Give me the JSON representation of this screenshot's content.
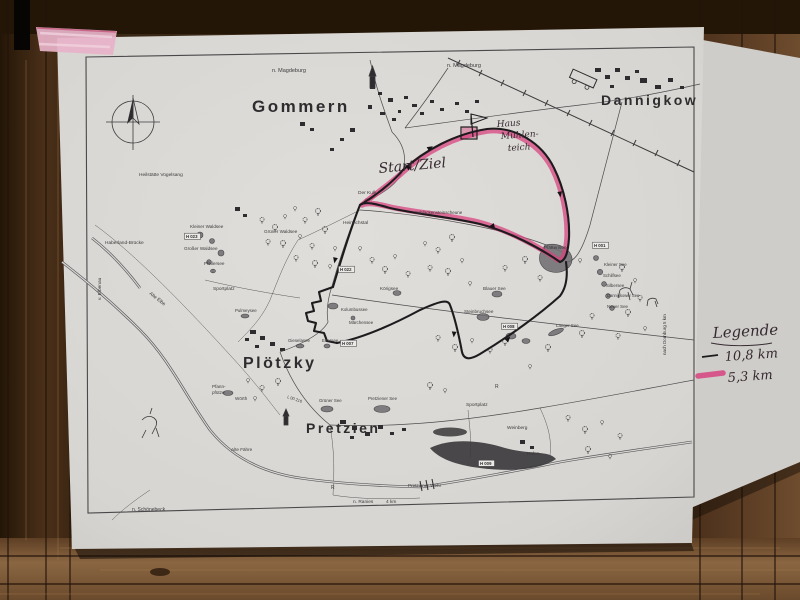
{
  "colors": {
    "paper": "#d9d7d3",
    "paper2": "#cfcdc9",
    "print": "#3c3a3c",
    "ink": "#352a31",
    "pink": "#d8437f",
    "tape": "#e7b3c8",
    "wood1": "#2f2013",
    "wood2": "#5d3f26",
    "wood3": "#8a6642"
  },
  "map": {
    "towns": [
      "Gommern",
      "Dannigkow",
      "Plötzky",
      "Pretzien"
    ],
    "legend": {
      "title": "Legende",
      "items": [
        {
          "label": "10,8 km",
          "color": "#1d1b1d",
          "style": "thin-line"
        },
        {
          "label": "5,3 km",
          "color": "#d8437f",
          "style": "thick-highlighter"
        }
      ]
    },
    "handwritten_annotations": [
      "Start/Ziel",
      "Haus Mühlen- teich",
      "Legende",
      "10,8 km",
      "5,3 km"
    ],
    "labels": [
      {
        "text": "Gommern",
        "x": 252,
        "y": 112,
        "cls": "town",
        "size": 17
      },
      {
        "text": "Dannigkow",
        "x": 601,
        "y": 105,
        "cls": "town",
        "size": 14
      },
      {
        "text": "Plötzky",
        "x": 243,
        "y": 368,
        "cls": "town",
        "size": 16
      },
      {
        "text": "Pretzien",
        "x": 306,
        "y": 433,
        "cls": "town",
        "size": 14
      },
      {
        "text": "n. Magdeburg",
        "x": 272,
        "y": 72,
        "size": 5.5
      },
      {
        "text": "n. Magdeburg",
        "x": 447,
        "y": 67,
        "size": 5.5
      },
      {
        "text": "n. Schönebeck",
        "x": 132,
        "y": 511,
        "size": 5
      },
      {
        "text": "n. Ranies",
        "x": 353,
        "y": 503,
        "size": 4.8
      },
      {
        "text": "4 km",
        "x": 386,
        "y": 503,
        "size": 4.8
      },
      {
        "text": "nach Dornburg 5 km",
        "x": 666,
        "y": 355,
        "size": 4.5,
        "rot": -90
      },
      {
        "text": "v. Elbenau",
        "x": 101,
        "y": 300,
        "size": 4.8,
        "rot": -90
      },
      {
        "text": "Heilstätte Vogelsang",
        "x": 139,
        "y": 176,
        "size": 4.8
      },
      {
        "text": "Haberland-Brücke",
        "x": 105,
        "y": 244,
        "size": 4.8
      },
      {
        "text": "Alte Elbe",
        "x": 149,
        "y": 294,
        "size": 4.8,
        "rot": 38
      },
      {
        "text": "Kleiner Waldsee",
        "x": 190,
        "y": 228,
        "size": 4.6
      },
      {
        "text": "Großer Waldsee",
        "x": 184,
        "y": 250,
        "size": 4.6
      },
      {
        "text": "Grüner Waldsee",
        "x": 264,
        "y": 233,
        "size": 4.6
      },
      {
        "text": "Pfeilersee",
        "x": 204,
        "y": 265,
        "size": 4.6
      },
      {
        "text": "Der Kulk",
        "x": 358,
        "y": 194,
        "size": 4.8
      },
      {
        "text": "Heinrichstal",
        "x": 343,
        "y": 224,
        "size": 4.8
      },
      {
        "text": "Schlackensteinscheune",
        "x": 415,
        "y": 214,
        "size": 4.5
      },
      {
        "text": "Körigsee",
        "x": 380,
        "y": 290,
        "size": 4.6
      },
      {
        "text": "Kolumbussee",
        "x": 341,
        "y": 311,
        "size": 4.4
      },
      {
        "text": "Märchensee",
        "x": 349,
        "y": 324,
        "size": 4.4
      },
      {
        "text": "Pulmeysee",
        "x": 235,
        "y": 312,
        "size": 4.4
      },
      {
        "text": "Sportplatz",
        "x": 213,
        "y": 290,
        "size": 4.8
      },
      {
        "text": "Gieselasee",
        "x": 288,
        "y": 342,
        "size": 4.4
      },
      {
        "text": "Edersee",
        "x": 322,
        "y": 342,
        "size": 4.4
      },
      {
        "text": "Plattensee",
        "x": 544,
        "y": 249,
        "size": 4.8
      },
      {
        "text": "Kleiner See",
        "x": 604,
        "y": 266,
        "size": 4.4
      },
      {
        "text": "Schilfsee",
        "x": 603,
        "y": 277,
        "size": 4.4
      },
      {
        "text": "Silbersee",
        "x": 606,
        "y": 287,
        "size": 4.4
      },
      {
        "text": "Dannigkower See",
        "x": 607,
        "y": 297,
        "size": 4.1
      },
      {
        "text": "Neuer See",
        "x": 607,
        "y": 308,
        "size": 4.4
      },
      {
        "text": "Blauer See",
        "x": 483,
        "y": 290,
        "size": 4.6
      },
      {
        "text": "Steinbruchsee",
        "x": 464,
        "y": 313,
        "size": 4.6
      },
      {
        "text": "Langer See",
        "x": 556,
        "y": 327,
        "size": 4.4
      },
      {
        "text": "Pfann-",
        "x": 212,
        "y": 388,
        "size": 4.6
      },
      {
        "text": "pfütze",
        "x": 212,
        "y": 394,
        "size": 4.6
      },
      {
        "text": "Wörth",
        "x": 235,
        "y": 400,
        "size": 4.6
      },
      {
        "text": "Alte Fähre",
        "x": 231,
        "y": 451,
        "size": 4.6
      },
      {
        "text": "Grüner See",
        "x": 319,
        "y": 402,
        "size": 4.4
      },
      {
        "text": "Pretziener See",
        "x": 368,
        "y": 400,
        "size": 4.4
      },
      {
        "text": "L 00 216",
        "x": 287,
        "y": 398,
        "size": 4,
        "rot": 18
      },
      {
        "text": "Sportplatz",
        "x": 466,
        "y": 406,
        "size": 4.8
      },
      {
        "text": "Weinberg",
        "x": 507,
        "y": 429,
        "size": 4.8
      },
      {
        "text": "Hafen",
        "x": 527,
        "y": 455,
        "size": 4.6
      },
      {
        "text": "Pretziener Wehr",
        "x": 408,
        "y": 487,
        "size": 4.6
      },
      {
        "text": "R",
        "x": 331,
        "y": 489,
        "size": 5
      },
      {
        "text": "R",
        "x": 495,
        "y": 388,
        "size": 5
      },
      {
        "text": "Start/Ziel",
        "x": 379,
        "y": 173,
        "cls": "hand",
        "size": 14,
        "rot": -5
      },
      {
        "text": "Haus",
        "x": 497,
        "y": 127,
        "cls": "hand",
        "size": 9,
        "rot": -4
      },
      {
        "text": "Mühlen-",
        "x": 501,
        "y": 139,
        "cls": "hand",
        "size": 9,
        "rot": -4
      },
      {
        "text": "teich",
        "x": 508,
        "y": 151,
        "cls": "hand",
        "size": 9,
        "rot": -4
      }
    ],
    "badges": [
      {
        "text": "H 023",
        "x": 186,
        "y": 238
      },
      {
        "text": "H 022",
        "x": 340,
        "y": 271
      },
      {
        "text": "H 007",
        "x": 342,
        "y": 345
      },
      {
        "text": "H 008",
        "x": 503,
        "y": 328
      },
      {
        "text": "H 009",
        "x": 480,
        "y": 465
      },
      {
        "text": "H 001",
        "x": 594,
        "y": 247
      }
    ]
  }
}
